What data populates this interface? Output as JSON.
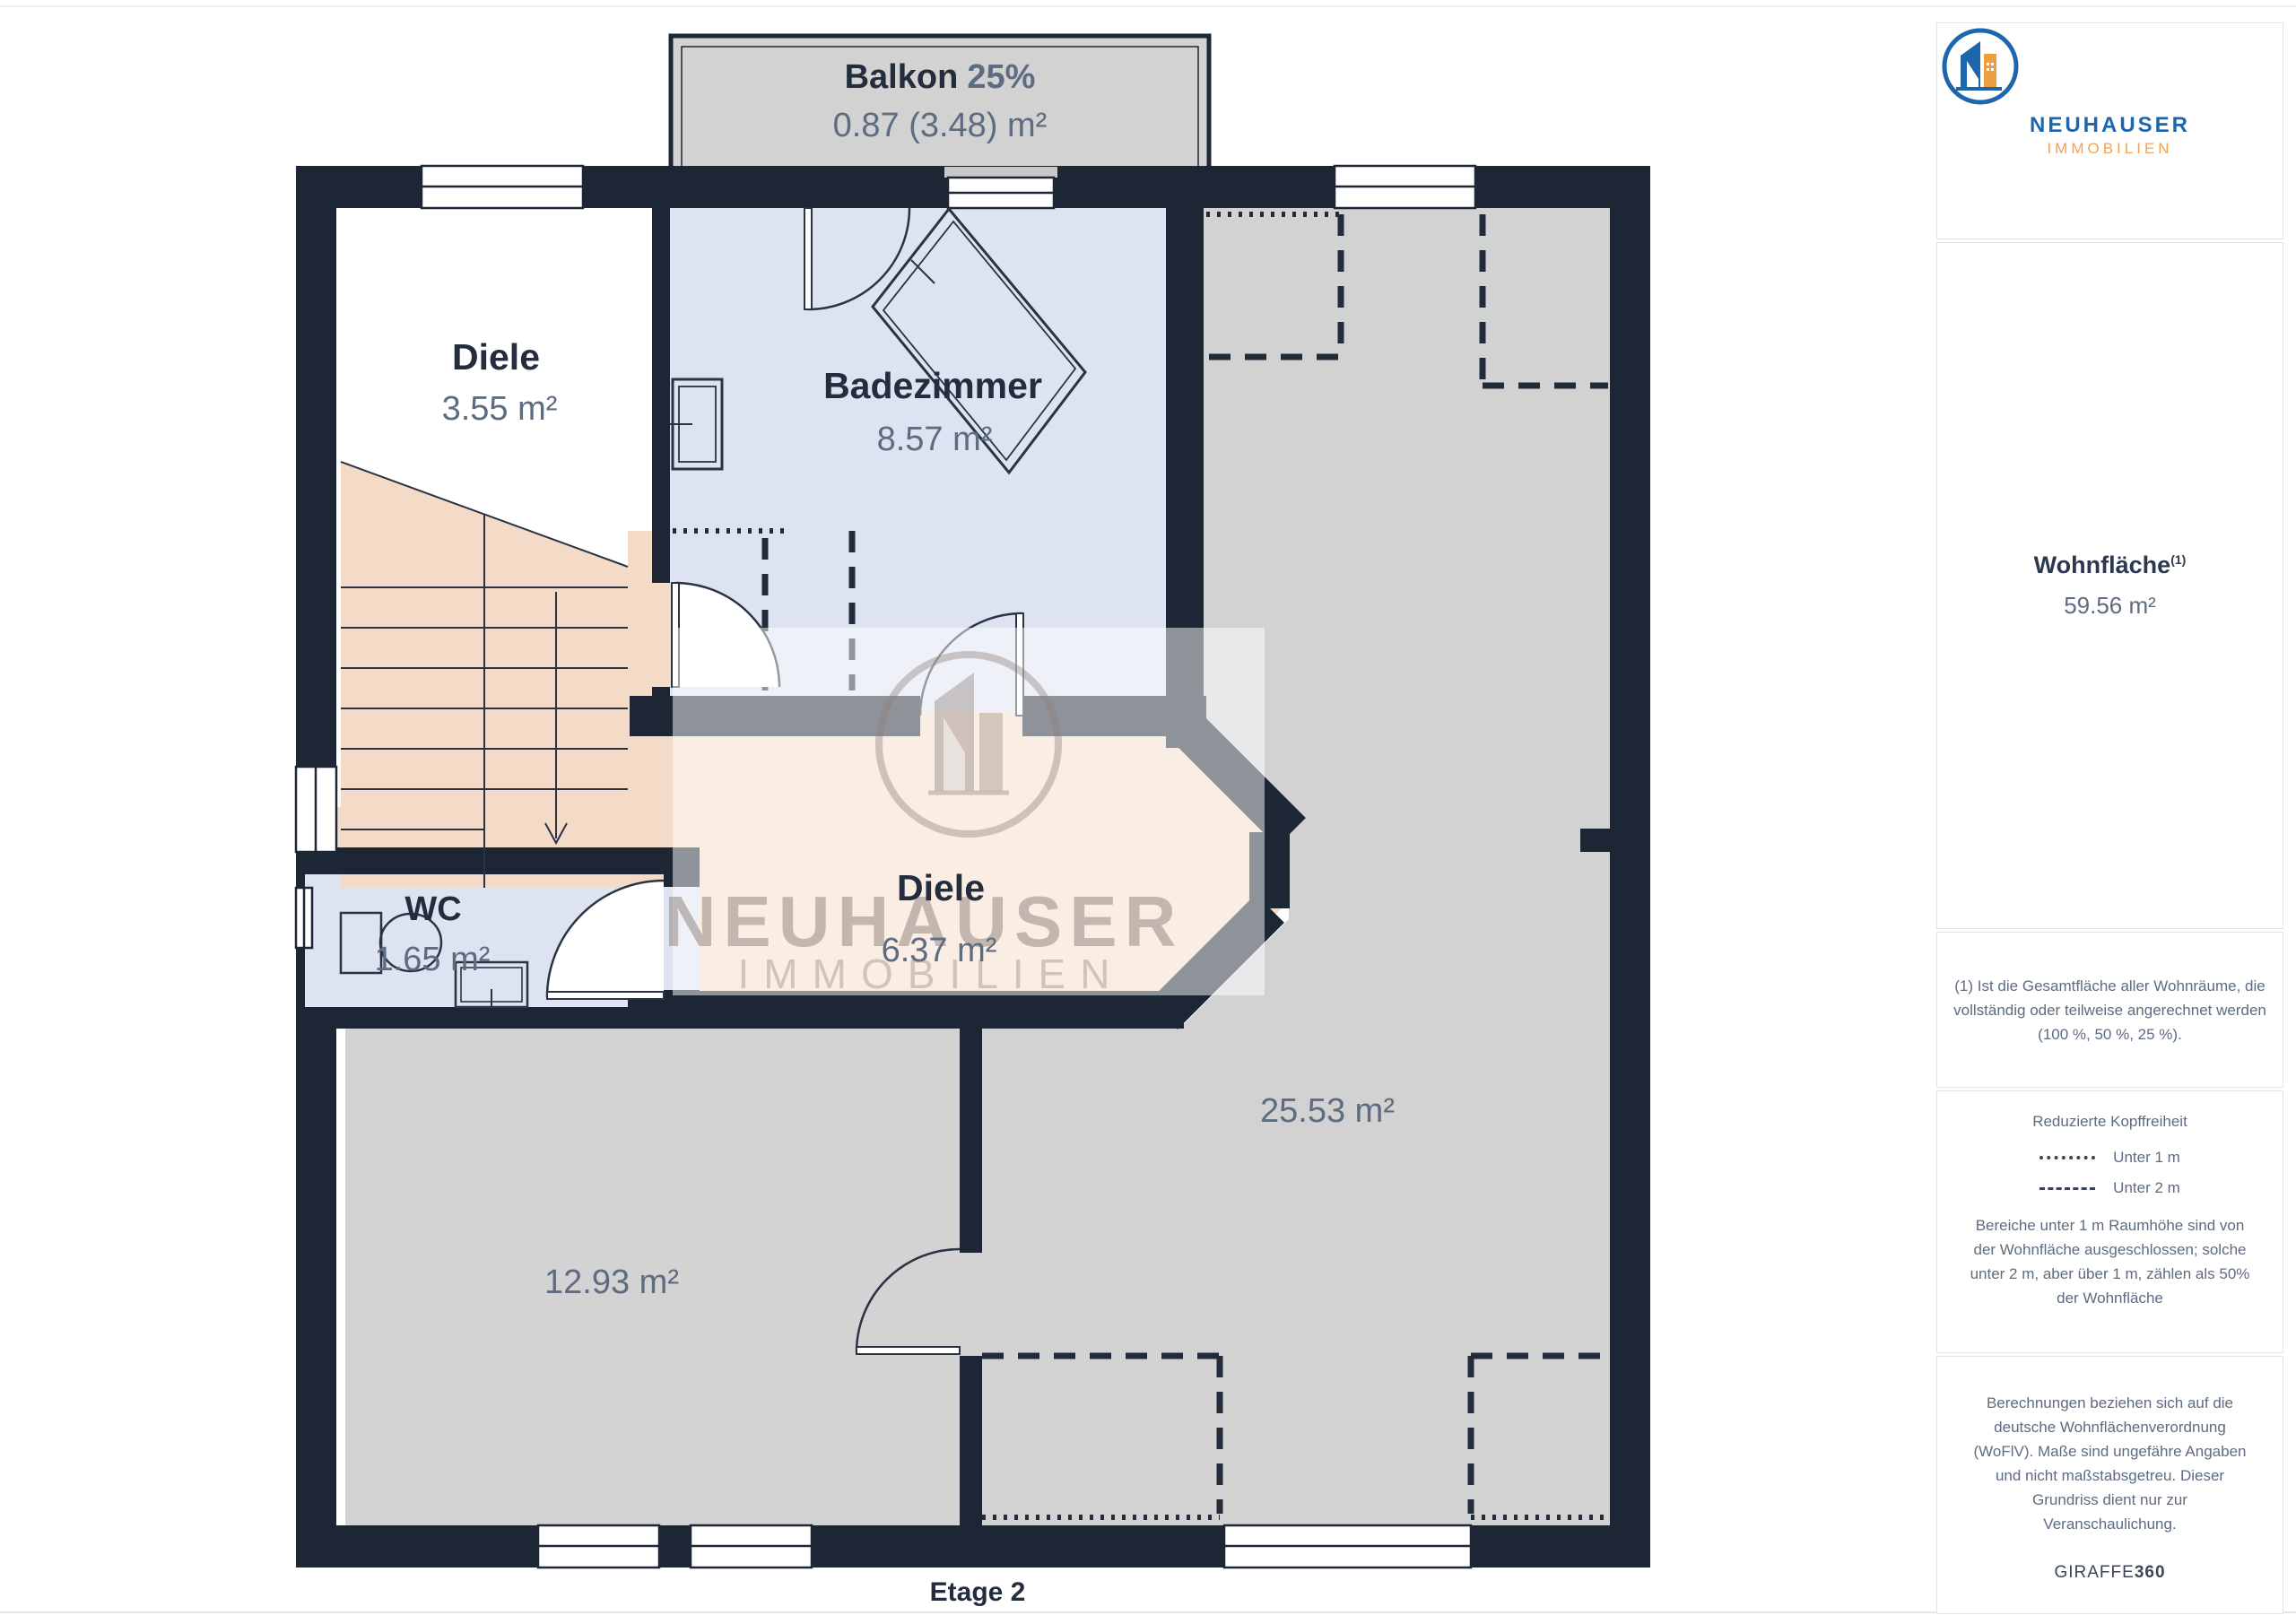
{
  "page": {
    "floor_label": "Etage 2"
  },
  "plan": {
    "rooms": [
      {
        "name": "Balkon",
        "share": "25%",
        "area": "0.87 (3.48) m²"
      },
      {
        "name": "Diele",
        "area": "3.55 m²"
      },
      {
        "name": "Badezimmer",
        "area": "8.57 m²"
      },
      {
        "name": "Diele",
        "area": "6.37 m²"
      },
      {
        "name": "WC",
        "area": "1.65 m²"
      },
      {
        "area": "12.93 m²"
      },
      {
        "area": "25.53 m²"
      }
    ],
    "watermark": {
      "brand": "NEUHAUSER",
      "subtitle": "IMMOBILIEN"
    }
  },
  "sidebar": {
    "logo": {
      "brand": "NEUHAUSER",
      "subtitle": "IMMOBILIEN"
    },
    "living_area": {
      "label": "Wohnfläche",
      "sup": "(1)",
      "value": "59.56 m²"
    },
    "note_area": "(1) Ist die Gesamtfläche aller Wohnräume, die vollständig oder teilweise angerechnet werden (100 %, 50 %, 25 %).",
    "headroom": {
      "title": "Reduzierte Kopffreiheit",
      "legend": [
        {
          "label": "Unter 1 m"
        },
        {
          "label": "Unter 2 m"
        }
      ],
      "note": "Bereiche unter 1 m Raumhöhe sind von der Wohnfläche ausgeschlossen; solche unter 2 m, aber über 1 m, zählen als 50% der Wohnfläche"
    },
    "disclaimer": "Berechnungen beziehen sich auf die deutsche Wohnflächenverordnung (WoFlV). Maße sind ungefähre Angaben und nicht maßstabsgetreu. Dieser Grundriss dient nur zur Veranschaulichung.",
    "brand": {
      "name": "GIRAFFE",
      "suffix": "360"
    }
  },
  "colors": {
    "wall": "#1d2634",
    "floor_gray": "#d3d3d4",
    "floor_blue": "#dde3f0",
    "floor_peach": "#f4dbc8",
    "brand_blue": "#1d66ac",
    "brand_orange": "#f0a353",
    "label_dark": "#232d3d",
    "label_slate": "#5d6c80"
  }
}
